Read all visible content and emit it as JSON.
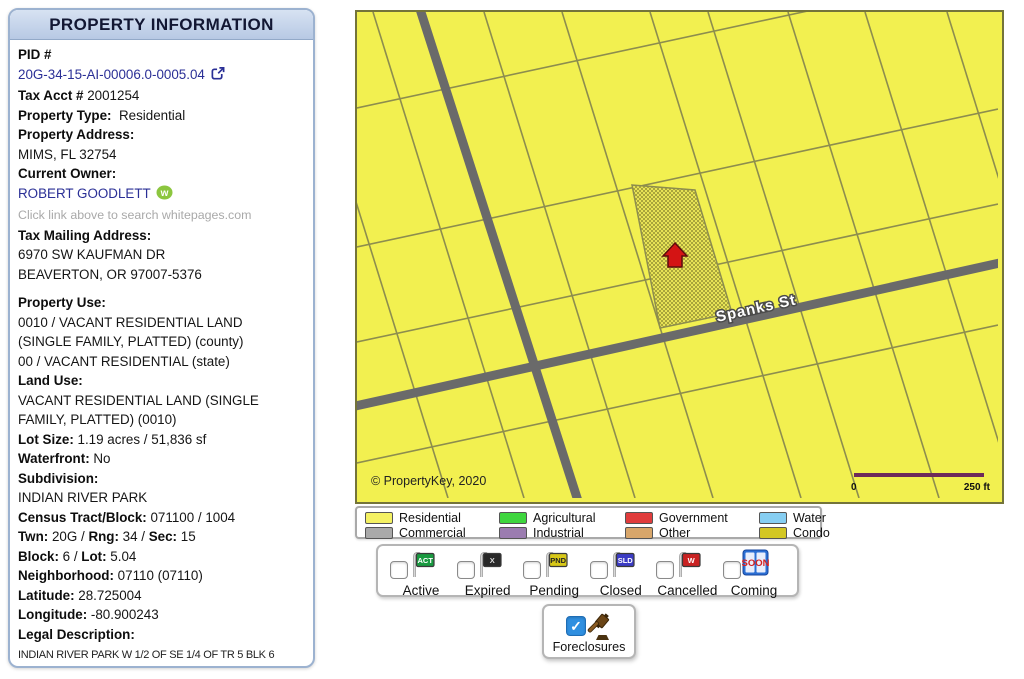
{
  "panel": {
    "title": "PROPERTY INFORMATION",
    "lines": [
      {
        "name": "pid-label-row",
        "segments": [
          {
            "style": "b",
            "text": "PID #"
          }
        ]
      },
      {
        "name": "pid-link-row",
        "segments": [
          {
            "style": "link",
            "name": "pid-link",
            "text": "20G-34-15-AI-00006.0-0005.04"
          },
          {
            "icon": "external-link-icon"
          }
        ]
      },
      {
        "name": "tax-acct-row",
        "segments": [
          {
            "style": "b",
            "text": "Tax Acct #"
          },
          {
            "style": "n",
            "text": " 2001254"
          }
        ]
      },
      {
        "name": "property-type-row",
        "segments": [
          {
            "style": "b",
            "text": "Property Type:"
          },
          {
            "style": "n",
            "text": "  Residential"
          }
        ]
      },
      {
        "name": "property-address-label",
        "segments": [
          {
            "style": "b",
            "text": "Property Address:"
          }
        ]
      },
      {
        "name": "property-address-value",
        "segments": [
          {
            "style": "n",
            "text": "MIMS, FL 32754"
          }
        ]
      },
      {
        "name": "current-owner-label",
        "segments": [
          {
            "style": "b",
            "text": "Current Owner:"
          }
        ]
      },
      {
        "name": "owner-link-row",
        "segments": [
          {
            "style": "link",
            "name": "owner-link",
            "text": "ROBERT GOODLETT"
          },
          {
            "icon": "whitepages-icon"
          }
        ]
      },
      {
        "name": "whitepages-hint",
        "segments": [
          {
            "style": "hint",
            "text": "Click link above to search whitepages.com"
          }
        ]
      },
      {
        "name": "tax-mailing-label",
        "segments": [
          {
            "style": "b",
            "text": "Tax Mailing Address:"
          }
        ]
      },
      {
        "name": "mailing-street",
        "segments": [
          {
            "style": "n",
            "text": "6970 SW KAUFMAN DR"
          }
        ]
      },
      {
        "name": "mailing-city",
        "segments": [
          {
            "style": "n",
            "text": "BEAVERTON, OR 97007-5376"
          }
        ]
      },
      {
        "gap": true
      },
      {
        "name": "property-use-label",
        "segments": [
          {
            "style": "b",
            "text": "Property Use:"
          }
        ]
      },
      {
        "name": "property-use-county-1",
        "segments": [
          {
            "style": "n",
            "text": "0010 / VACANT RESIDENTIAL LAND"
          }
        ]
      },
      {
        "name": "property-use-county-2",
        "segments": [
          {
            "style": "n",
            "text": "(SINGLE FAMILY, PLATTED) (county)"
          }
        ]
      },
      {
        "name": "property-use-state",
        "segments": [
          {
            "style": "n",
            "text": "00 / VACANT RESIDENTIAL (state)"
          }
        ]
      },
      {
        "name": "land-use-label",
        "segments": [
          {
            "style": "b",
            "text": "Land Use:"
          }
        ]
      },
      {
        "name": "land-use-value-1",
        "segments": [
          {
            "style": "n",
            "text": "VACANT RESIDENTIAL LAND (SINGLE"
          }
        ]
      },
      {
        "name": "land-use-value-2",
        "segments": [
          {
            "style": "n",
            "text": "FAMILY, PLATTED) (0010)"
          }
        ]
      },
      {
        "name": "lot-size-row",
        "segments": [
          {
            "style": "b",
            "text": "Lot Size:"
          },
          {
            "style": "n",
            "text": " 1.19 acres / 51,836 sf"
          }
        ]
      },
      {
        "name": "waterfront-row",
        "segments": [
          {
            "style": "b",
            "text": "Waterfront:"
          },
          {
            "style": "n",
            "text": " No"
          }
        ]
      },
      {
        "name": "subdivision-label",
        "segments": [
          {
            "style": "b",
            "text": "Subdivision:"
          }
        ]
      },
      {
        "name": "subdivision-value",
        "segments": [
          {
            "style": "n",
            "text": "INDIAN RIVER PARK"
          }
        ]
      },
      {
        "name": "census-row",
        "segments": [
          {
            "style": "b",
            "text": "Census Tract/Block:"
          },
          {
            "style": "n",
            "text": " 071100 / 1004"
          }
        ]
      },
      {
        "name": "twn-rng-sec-row",
        "segments": [
          {
            "style": "b",
            "text": "Twn:"
          },
          {
            "style": "n",
            "text": " 20G / "
          },
          {
            "style": "b",
            "text": "Rng:"
          },
          {
            "style": "n",
            "text": " 34 / "
          },
          {
            "style": "b",
            "text": "Sec:"
          },
          {
            "style": "n",
            "text": " 15"
          }
        ]
      },
      {
        "name": "block-lot-row",
        "segments": [
          {
            "style": "b",
            "text": "Block:"
          },
          {
            "style": "n",
            "text": " 6 / "
          },
          {
            "style": "b",
            "text": "Lot:"
          },
          {
            "style": "n",
            "text": " 5.04"
          }
        ]
      },
      {
        "name": "neighborhood-row",
        "segments": [
          {
            "style": "b",
            "text": "Neighborhood:"
          },
          {
            "style": "n",
            "text": " 07110 (07110)"
          }
        ]
      },
      {
        "name": "latitude-row",
        "segments": [
          {
            "style": "b",
            "text": "Latitude:"
          },
          {
            "style": "n",
            "text": " 28.725004"
          }
        ]
      },
      {
        "name": "longitude-row",
        "segments": [
          {
            "style": "b",
            "text": "Longitude:"
          },
          {
            "style": "n",
            "text": " -80.900243"
          }
        ]
      },
      {
        "name": "legal-description-label",
        "segments": [
          {
            "style": "b",
            "text": "Legal Description:"
          }
        ]
      },
      {
        "name": "legal-description-value",
        "segments": [
          {
            "style": "legal",
            "text": "INDIAN RIVER PARK W 1/2 OF SE 1/4 OF TR 5 BLK 6"
          }
        ]
      }
    ]
  },
  "map": {
    "street_label": "Spanks St",
    "copyright": "© PropertyKey, 2020",
    "scale_start": "0",
    "scale_end": "250 ft",
    "colors": {
      "parcel_fill": "#f2f050",
      "parcel_line": "#8d8d4e",
      "road": "#6a6a6a",
      "selected_hatch": "#a9a53c",
      "marker": "#d41414"
    }
  },
  "legend": {
    "items": [
      {
        "label": "Residential",
        "color": "#f4f163"
      },
      {
        "label": "Commercial",
        "color": "#a9a9a9"
      },
      {
        "label": "Agricultural",
        "color": "#3ed63e"
      },
      {
        "label": "Industrial",
        "color": "#9b7cb0"
      },
      {
        "label": "Government",
        "color": "#e03c3c"
      },
      {
        "label": "Other",
        "color": "#d8a66a"
      },
      {
        "label": "Water",
        "color": "#86cef2"
      },
      {
        "label": "Condo",
        "color": "#d3c723"
      }
    ]
  },
  "statuses": {
    "items": [
      {
        "label": "Active",
        "flag": "ACT",
        "color": "#199a40",
        "text_color": "#ffffff",
        "checked": false
      },
      {
        "label": "Expired",
        "flag": "X",
        "color": "#282828",
        "text_color": "#dddddd",
        "checked": false
      },
      {
        "label": "Pending",
        "flag": "PND",
        "color": "#d8c818",
        "text_color": "#222222",
        "checked": false
      },
      {
        "label": "Closed",
        "flag": "SLD",
        "color": "#3b3bc4",
        "text_color": "#ffffff",
        "checked": false
      },
      {
        "label": "Cancelled",
        "flag": "W",
        "color": "#c92222",
        "text_color": "#ffffff",
        "checked": false
      },
      {
        "label": "Coming",
        "sign": "SOON",
        "color": "#2b6fd4",
        "text_color": "#d42020",
        "checked": false
      }
    ]
  },
  "foreclosures": {
    "label": "Foreclosures",
    "checked": true
  }
}
